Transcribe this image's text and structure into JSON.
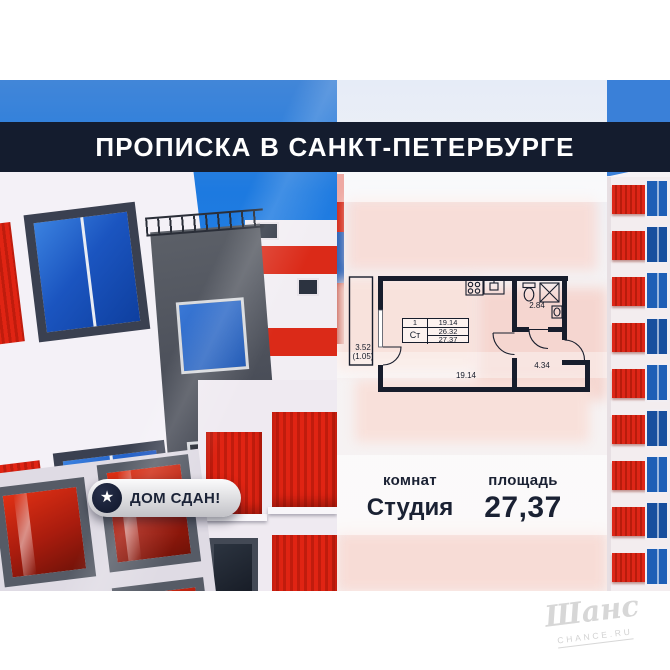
{
  "banner": {
    "title": "ПРОПИСКА В САНКТ-ПЕТЕРБУРГЕ"
  },
  "badge": {
    "label": "ДОМ СДАН!",
    "icon": "star-icon"
  },
  "floor_plan": {
    "spec_table": {
      "rooms": "1",
      "unit_type": "Ст",
      "rows": [
        "19.14",
        "26.32",
        "27.37"
      ]
    },
    "room_area": "19.14",
    "bathroom_area": "2.84",
    "hallway_area": "4.34",
    "balcony_area": "3.52",
    "balcony_area_reduced": "(1.05)"
  },
  "summary": {
    "rooms_label": "комнат",
    "rooms_value": "Студия",
    "area_label": "площадь",
    "area_value": "27,37"
  },
  "watermark": {
    "brand": "Шанс",
    "site": "CHANCE.RU"
  },
  "colors": {
    "banner_bg": "#141c2e",
    "accent_red": "#dd2414",
    "window_blue": "#1d5fb6",
    "text_navy": "#1a2133",
    "sky_blue": "#2b7fe0"
  }
}
